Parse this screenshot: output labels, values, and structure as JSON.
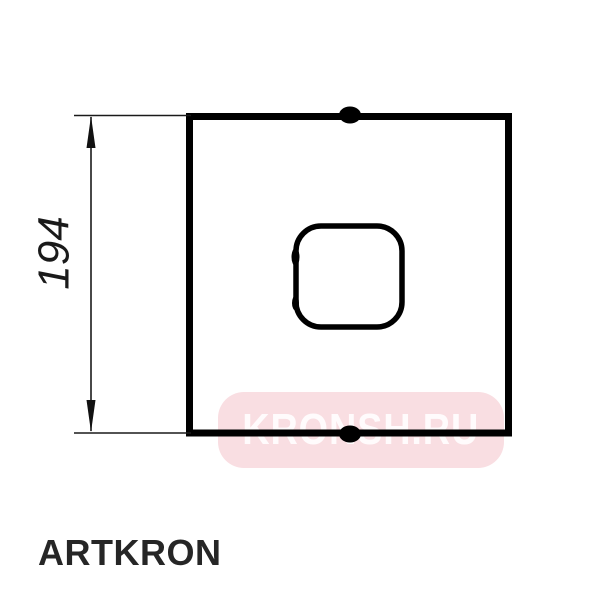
{
  "page": {
    "background_color": "#ffffff"
  },
  "drawing": {
    "type": "technical-drawing-front-view",
    "description": "Square mounting plate with central rounded-square hole, small tabs top and bottom",
    "line_color": "#000000",
    "dimension": {
      "label": "194",
      "orientation": "vertical",
      "measures": "plate height"
    }
  },
  "watermark": {
    "text": "KRONSH.RU",
    "background_color": "#f9dee2",
    "text_color": "#ffffff"
  },
  "brand": {
    "label": "ARTKRON",
    "color": "#262626"
  }
}
